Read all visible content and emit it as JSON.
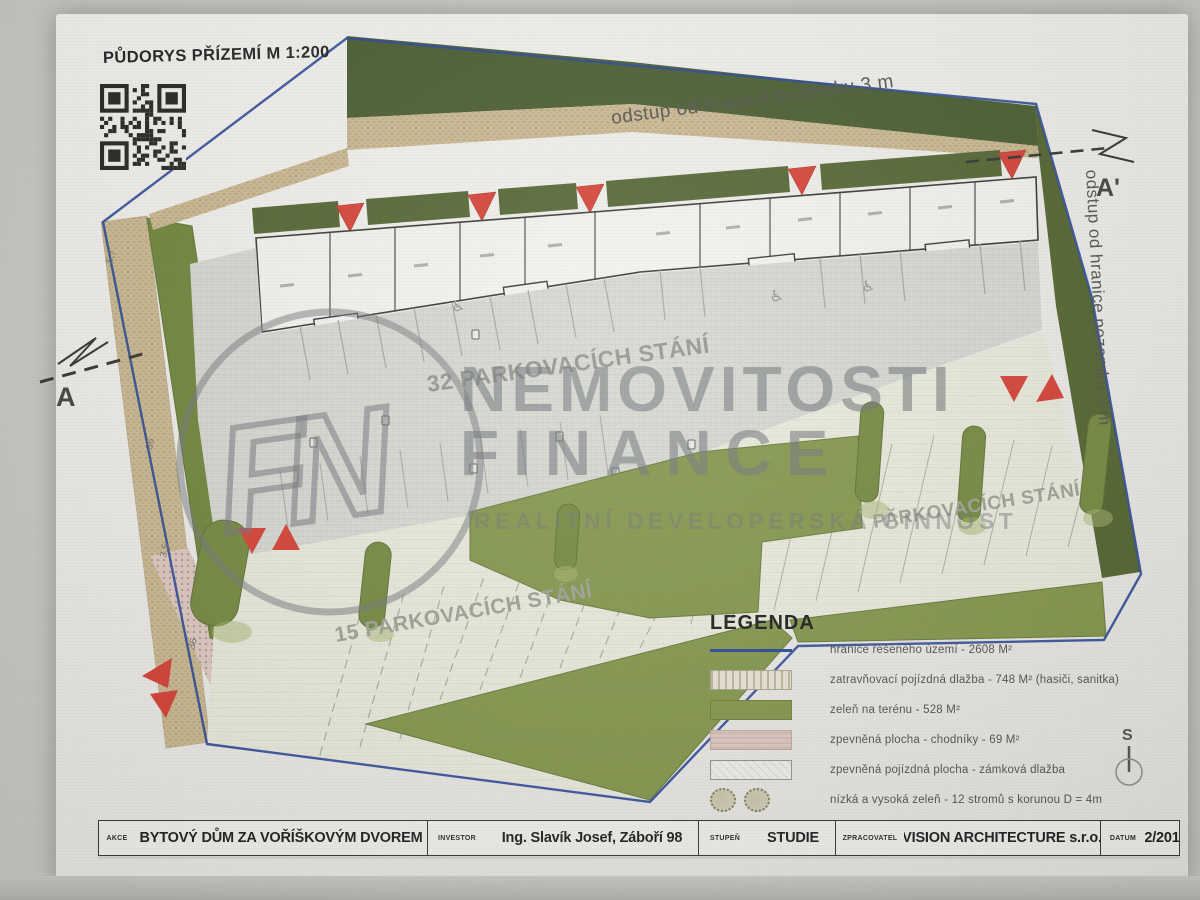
{
  "drawing": {
    "title": "PŮDORYS PŘÍZEMÍ M 1:200",
    "setback_top": "odstup od hranice pozemku 3 m",
    "setback_right": "odstup od hranice pozemku 3 m",
    "parking_main": "32 PARKOVACÍCH STÁNÍ",
    "parking_left": "15 PARKOVACÍCH STÁNÍ",
    "parking_right": "PARKOVACÍCH STÁNÍ",
    "section_left": "A",
    "section_right": "A'",
    "north": "S",
    "dimensions": [
      "5,7",
      "36",
      "3,5",
      "36"
    ]
  },
  "watermark": {
    "line1": "NEMOVITOSTI",
    "line2": "FINANCE",
    "tagline": "REALITNÍ DEVELOPERSKÁ ČINNOST",
    "monogram": "FN"
  },
  "legend": {
    "title": "LEGENDA",
    "items": [
      {
        "swatch": "boundary-line",
        "label": "hranice řešeného území - 2608 M²"
      },
      {
        "swatch": "grass-paver",
        "label": "zatravňovací pojízdná dlažba - 748 M² (hasiči, sanitka)"
      },
      {
        "swatch": "green-area",
        "label": "zeleň na terénu - 528 M²"
      },
      {
        "swatch": "walkway",
        "label": "zpevněná plocha - chodníky - 69 M²"
      },
      {
        "swatch": "block-paving",
        "label": "zpevněná pojízdná plocha - zámková dlažba"
      },
      {
        "swatch": "trees",
        "label": "nízká a vysoká zeleň - 12 stromů s korunou D = 4m"
      }
    ]
  },
  "title_block": {
    "fields": [
      {
        "label": "AKCE",
        "value": "BYTOVÝ DŮM  ZA VOŘÍŠKOVÝM DVOREM"
      },
      {
        "label": "INVESTOR",
        "value": "Ing. Slavík Josef, Záboří 98"
      },
      {
        "label": "STUPEŇ",
        "value": "STUDIE"
      },
      {
        "label": "ZPRACOVATEL",
        "value": "VISION ARCHITECTURE s.r.o."
      },
      {
        "label": "DATUM",
        "value": "12/2018"
      }
    ]
  },
  "colors": {
    "boundary_blue": "#1e3d90",
    "dark_green": "#3f5423",
    "grass_green": "#7c9140",
    "tan_paver": "#c9b68c",
    "walkway_pink": "#dcc7bc",
    "parking_gray": "#d7d7d1",
    "marker_red": "#d4372a"
  }
}
